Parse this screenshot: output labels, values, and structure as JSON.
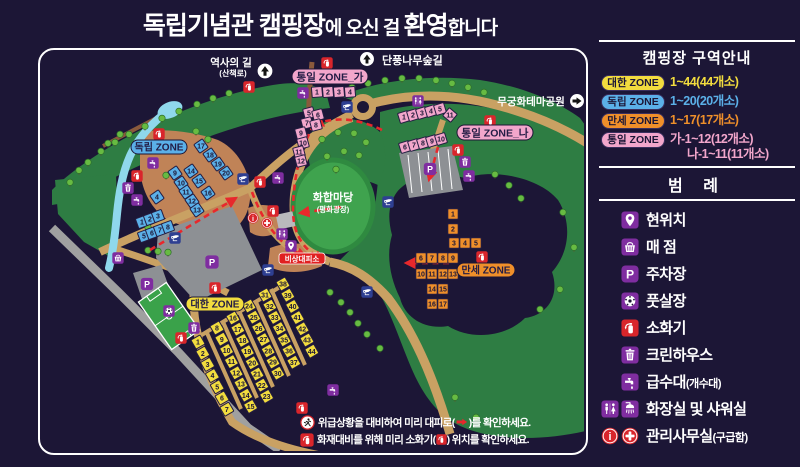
{
  "title": {
    "part1": "독립기념관 캠핑장",
    "part2": "에 오신 걸 ",
    "part3": "환영",
    "part4": "합니다"
  },
  "zone_info": {
    "title": "캠핑장 구역안내",
    "rows": [
      {
        "badge": "대한 ZONE",
        "range": "1~44(44개소)",
        "color": "#f2dc3e"
      },
      {
        "badge": "독립 ZONE",
        "range": "1~20(20개소)",
        "color": "#5bb0e8"
      },
      {
        "badge": "만세 ZONE",
        "range": "1~17(17개소)",
        "color": "#ef8f2a"
      },
      {
        "badge": "통일 ZONE",
        "range": "가-1~12(12개소)",
        "range2": "나-1~11(11개소)",
        "color": "#f2a6cb"
      }
    ]
  },
  "legend": {
    "title": "범  례",
    "items": [
      {
        "icons": [
          "pin"
        ],
        "label": "현위치"
      },
      {
        "icons": [
          "basket"
        ],
        "label": "매  점"
      },
      {
        "icons": [
          "parking"
        ],
        "label": "주차장"
      },
      {
        "icons": [
          "soccer"
        ],
        "label": "풋살장"
      },
      {
        "icons": [
          "fire"
        ],
        "label": "소화기"
      },
      {
        "icons": [
          "trash"
        ],
        "label": "크린하우스"
      },
      {
        "icons": [
          "water"
        ],
        "label": "급수대",
        "sub": "(개수대)"
      },
      {
        "icons": [
          "restroom",
          "shower"
        ],
        "label": "화장실 및 샤워실"
      },
      {
        "icons": [
          "info",
          "aid"
        ],
        "label": "관리사무실",
        "sub": "(구급함)"
      }
    ]
  },
  "map": {
    "labels": {
      "history": "역사의 길",
      "history_sub": "(산책로)",
      "maple": "단풍나무숲길",
      "mugunghwa": "무궁화테마공원",
      "plaza": "화합마당",
      "plaza_sub": "(평화광장)",
      "shelter": "비상대피소",
      "zone_daehan": "대한 ZONE",
      "zone_dokrip": "독립 ZONE",
      "zone_manse": "만세 ZONE",
      "zone_tongil_ga": "통일 ZONE_가",
      "zone_tongil_na": "통일 ZONE_나"
    },
    "zones": {
      "daehan": {
        "color": "#f2dc3e",
        "sites": [
          "1",
          "2",
          "3",
          "4",
          "5",
          "6",
          "7",
          "8",
          "9",
          "10",
          "11",
          "12",
          "13",
          "14",
          "15",
          "16",
          "17",
          "18",
          "19",
          "20",
          "21",
          "22",
          "23",
          "24",
          "25",
          "26",
          "27",
          "28",
          "29",
          "30",
          "31",
          "32",
          "33",
          "34",
          "35",
          "36",
          "37",
          "38",
          "39",
          "40",
          "41",
          "42",
          "43",
          "44"
        ]
      },
      "dokrip": {
        "color": "#5bb0e8",
        "sites": [
          "1",
          "2",
          "3",
          "4",
          "5",
          "6",
          "7",
          "8",
          "9",
          "10",
          "11",
          "12",
          "13",
          "14",
          "15",
          "16",
          "17",
          "18",
          "19",
          "20"
        ]
      },
      "manse": {
        "color": "#ef8f2a",
        "sites": [
          "1",
          "2",
          "3",
          "4",
          "5",
          "6",
          "7",
          "8",
          "9",
          "10",
          "11",
          "12",
          "13",
          "14",
          "15",
          "16",
          "17"
        ]
      },
      "tongil_ga": {
        "color": "#f2a6cb",
        "sites": [
          "1",
          "2",
          "3",
          "4",
          "5",
          "6",
          "7",
          "8",
          "9",
          "10",
          "11",
          "12"
        ]
      },
      "tongil_na": {
        "color": "#f2a6cb",
        "sites": [
          "1",
          "2",
          "3",
          "4",
          "5",
          "6",
          "7",
          "8",
          "9",
          "10",
          "11"
        ]
      }
    }
  },
  "notices": [
    {
      "pre": "위급상황을 대비하여 미리 대피로(",
      "post": ")를 확인하세요."
    },
    {
      "pre": "화재대비를 위해 미리 소화기(",
      "post": ") 위치를 확인하세요."
    }
  ],
  "colors": {
    "background": "#1c1636",
    "map_green": "#2e7d43",
    "plaza_green": "#3fa34e",
    "road_tan": "#c9a163",
    "road_gray": "#a0a0a0",
    "stream_blue": "#8fd8ec",
    "purple_icon": "#7f2da0",
    "red": "#d9252b",
    "evac_red": "#e8282c",
    "daehan": "#f2dc3e",
    "dokrip": "#5bb0e8",
    "manse": "#ef8f2a",
    "tongil": "#f2a6cb"
  }
}
